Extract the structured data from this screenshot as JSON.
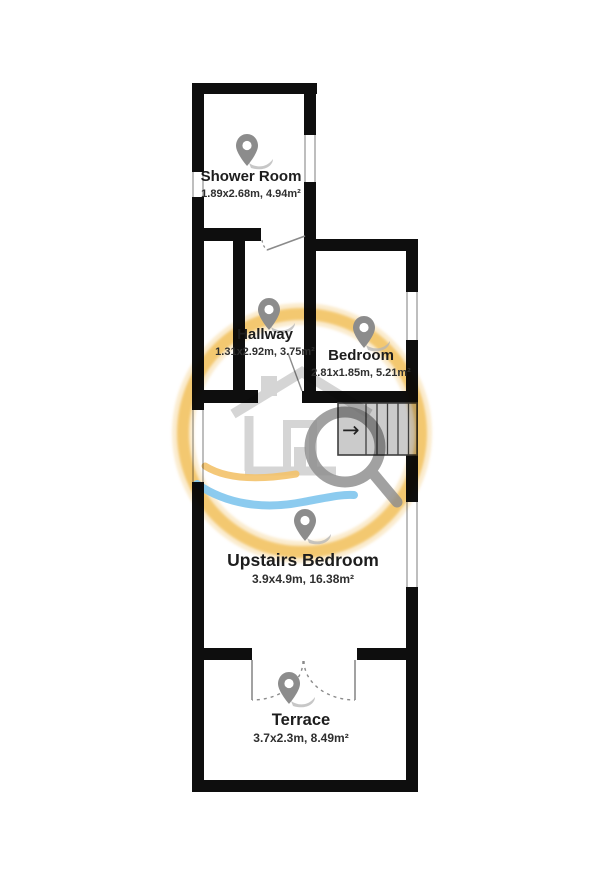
{
  "rooms": [
    {
      "name": "Shower Room",
      "dims": "1.89x2.68m, 4.94m²"
    },
    {
      "name": "Hallway",
      "dims": "1.31x2.92m, 3.75m²"
    },
    {
      "name": "Bedroom",
      "dims": "2.81x1.85m, 5.21m²"
    },
    {
      "name": "Upstairs Bedroom",
      "dims": "3.9x4.9m, 16.38m²"
    },
    {
      "name": "Terrace",
      "dims": "3.7x2.3m, 8.49m²"
    }
  ],
  "stairs": {
    "direction_arrow": "→"
  },
  "colors": {
    "wall": "#0e0e0e",
    "window_line": "#9c9c9c",
    "door_line": "#8a8a8a",
    "stair_fill": "#cbcbcb",
    "stair_line": "#3f3f3f",
    "pin": "#8c8c8c",
    "pin_shadow": "#b4b4b4",
    "text": "#1d1d1d",
    "dim_text": "#2f2f2f",
    "ring": "#f2c66c",
    "wave_blue": "#86c8ee",
    "wave_orange": "#f3c26a",
    "house": "#a8a8a8",
    "magnifier": "#8d8d8d"
  }
}
